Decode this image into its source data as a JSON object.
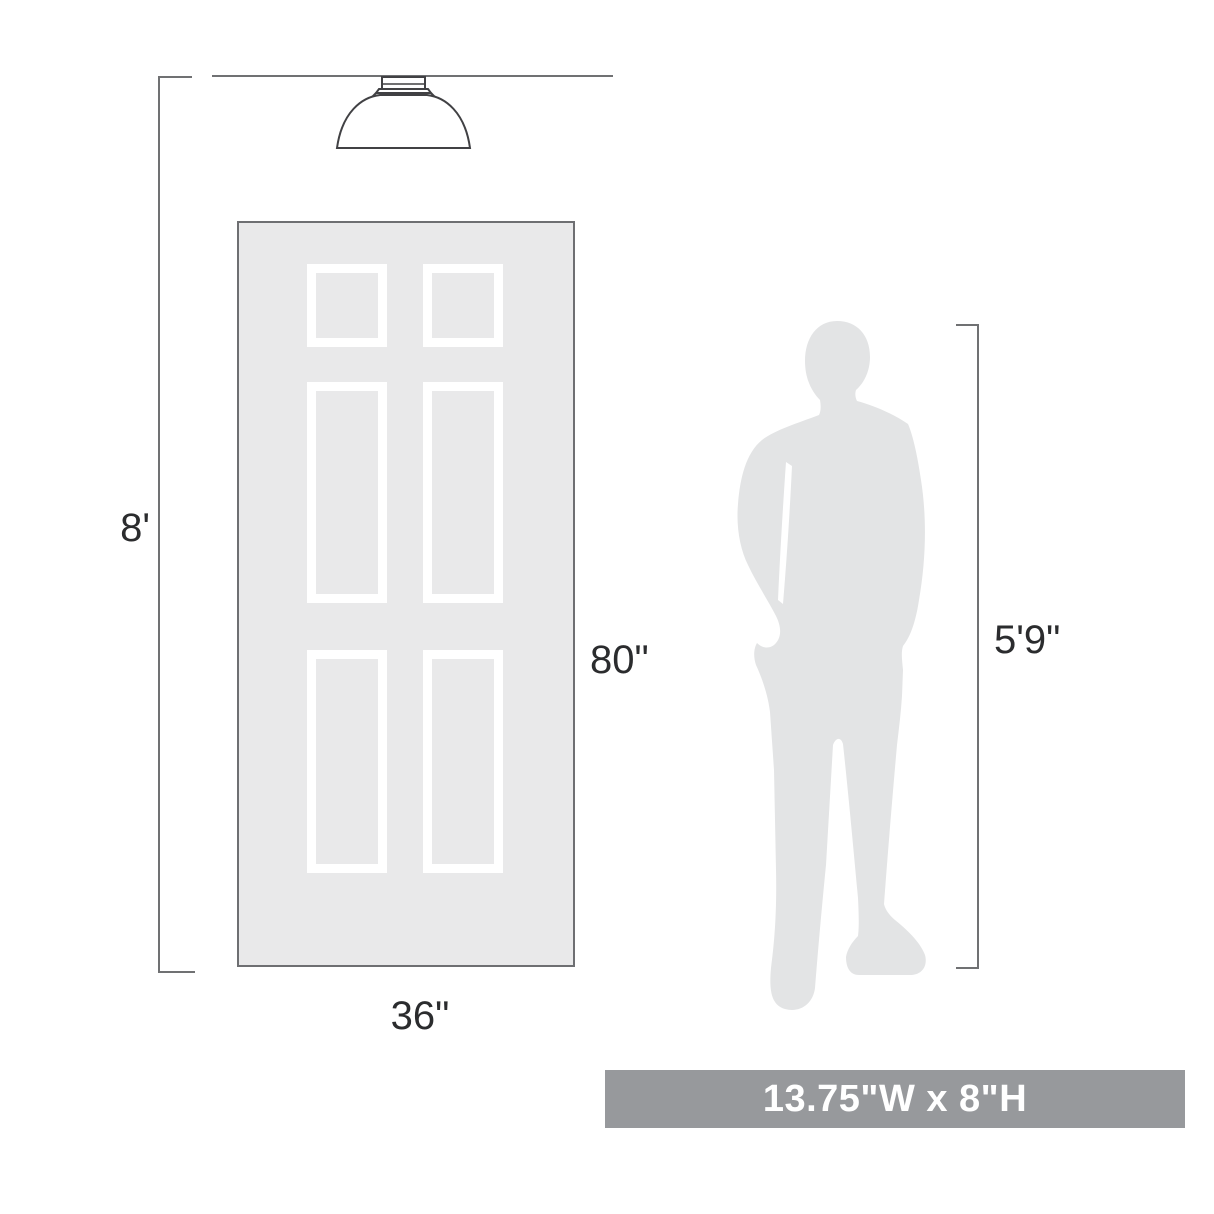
{
  "diagram": {
    "type": "product-scale-diagram",
    "labels": {
      "ceiling_height": "8'",
      "door_height": "80\"",
      "door_width": "36\"",
      "person_height": "5'9\""
    },
    "banner": {
      "text": "13.75\"W x 8\"H",
      "background": "#97999c",
      "text_color": "#ffffff"
    },
    "colors": {
      "door_fill": "#e9e9ea",
      "door_border": "#6e6f72",
      "panel_frame": "#ffffff",
      "person_fill": "#e3e4e5",
      "dimension_line": "#707173",
      "fixture_outline": "#414144",
      "label_text": "#2b2c2e"
    },
    "objects": {
      "fixture": "flush-mount-ceiling-light",
      "door": "six-panel-door",
      "person": "man-silhouette"
    }
  }
}
